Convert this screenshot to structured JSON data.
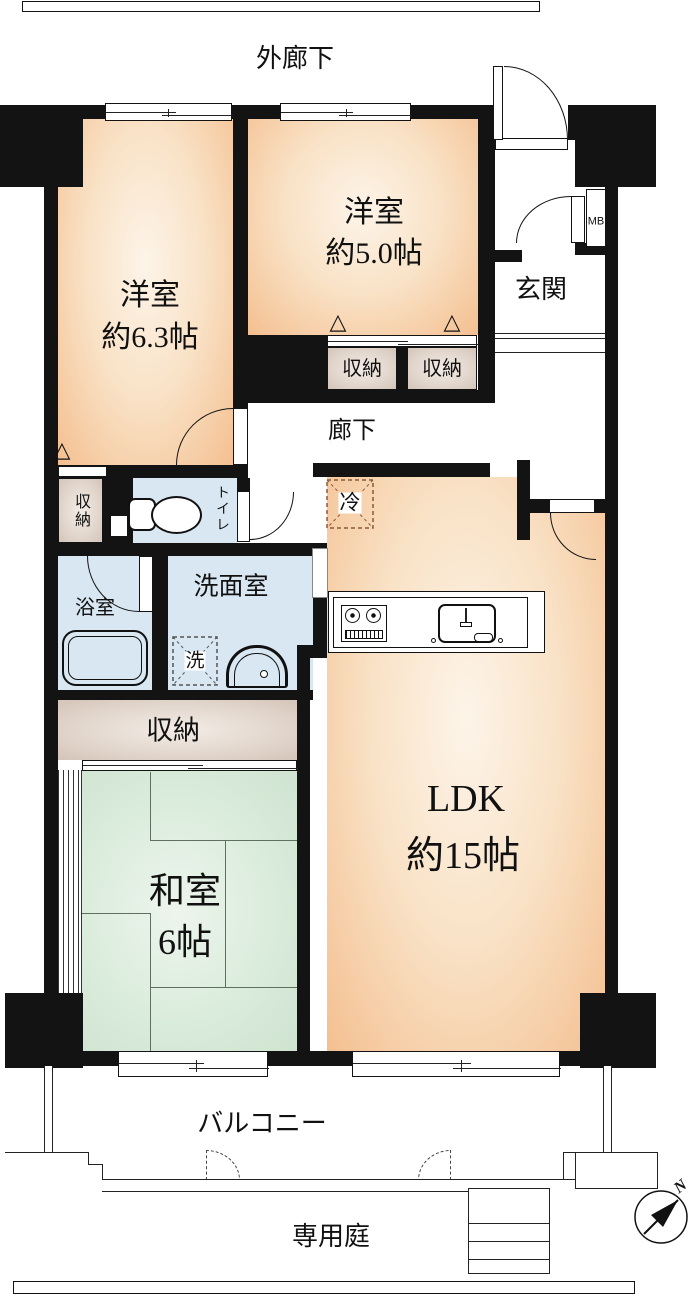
{
  "plan": {
    "exterior_corridor": "外廊下",
    "hallway": "廊下",
    "entrance": "玄関",
    "meter_box": "MB",
    "balcony": "バルコニー",
    "private_garden": "専用庭",
    "compass_north": "N",
    "rooms": {
      "western1": {
        "name": "洋室",
        "size": "約6.3帖"
      },
      "western2": {
        "name": "洋室",
        "size": "約5.0帖"
      },
      "ldk": {
        "name": "LDK",
        "size": "約15帖"
      },
      "japanese": {
        "name": "和室",
        "size": "6帖"
      }
    },
    "fixtures": {
      "closet": "収納",
      "toilet": "トイレ",
      "bathroom": "浴室",
      "washroom": "洗面室",
      "washer": "洗",
      "refrigerator": "冷"
    },
    "symbols": {
      "pillar_marker": "△"
    },
    "colors": {
      "wall": "#131313",
      "western_room_fill": "#f4bf90",
      "room_highlight": "#fdf4e9",
      "tatami_fill": "#d5e8d6",
      "wet_area_fill": "#d8e7f1",
      "closet_fill": "#d4c4b9"
    }
  }
}
